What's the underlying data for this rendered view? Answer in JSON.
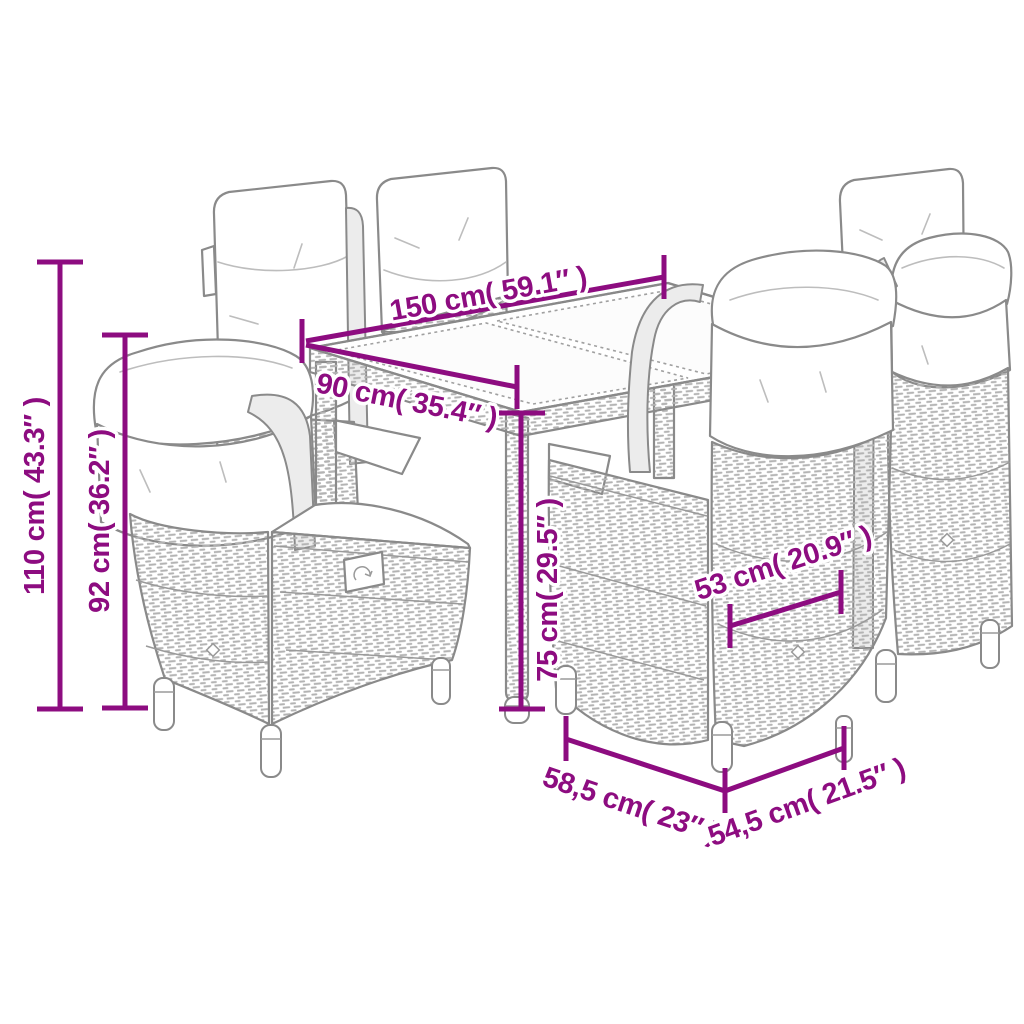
{
  "diagram": {
    "kind": "product dimension line drawing",
    "subject": "outdoor rattan dining set: glass-top table with six high-back cushioned chairs",
    "background_color": "#ffffff",
    "accent_color": "#8d0c80",
    "line_art_color": "#8a8a8a",
    "cushion_color": "#ffffff"
  },
  "dims": {
    "d150": {
      "label": "150 cm( 59.1″ )"
    },
    "d90": {
      "label": "90 cm( 35.4″ )"
    },
    "d110": {
      "label": "110 cm( 43.3″ )"
    },
    "d92": {
      "label": "92 cm( 36.2″ )"
    },
    "d75": {
      "label": "75 cm( 29.5″ )"
    },
    "d53": {
      "label": "53 cm( 20.9″ )"
    },
    "d58_5": {
      "label": "58,5 cm( 23″ )"
    },
    "d54_5": {
      "label": "54,5 cm( 21.5″ )"
    }
  }
}
